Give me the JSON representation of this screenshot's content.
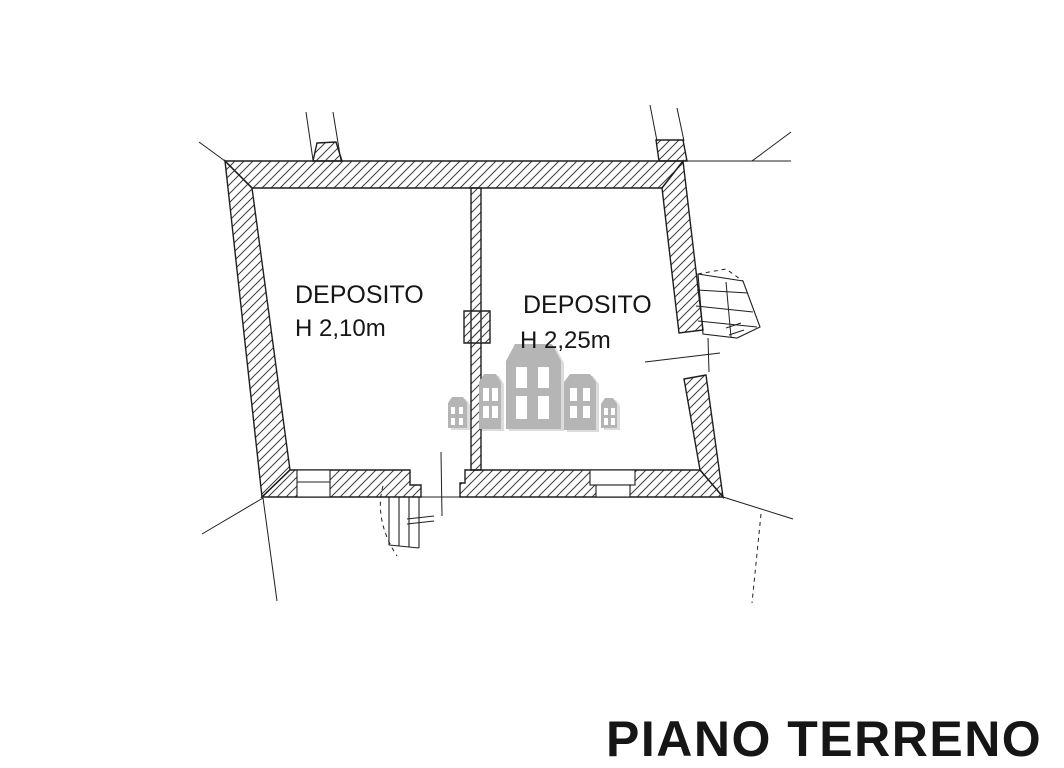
{
  "plan": {
    "title": "PIANO TERRENO",
    "rooms": [
      {
        "name": "DEPOSITO",
        "ceiling_height": "H 2,10m"
      },
      {
        "name": "DEPOSITO",
        "ceiling_height": "H 2,25m"
      }
    ],
    "watermark": {
      "icon": "buildings-icon",
      "building_count": 5
    },
    "colors": {
      "wall_line": "#1f1f1f",
      "hatch_line": "#3c3c3c",
      "text": "#161616",
      "watermark_gray": "#b5b5b5",
      "background": "#ffffff"
    }
  }
}
